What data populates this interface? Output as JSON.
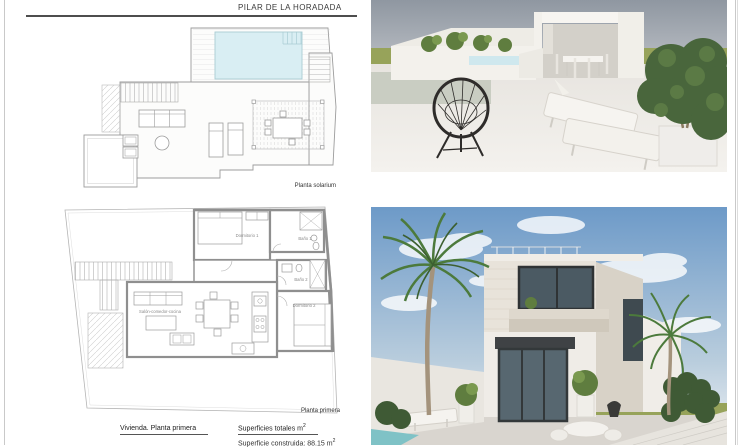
{
  "page": {
    "title": "PILAR DE LA HORADADA"
  },
  "plans": {
    "solarium": {
      "label": "Planta solarium"
    },
    "primera": {
      "label": "Planta primera",
      "rooms": {
        "dormitorio1": "Dormitorio 1",
        "bano1": "Baño 1",
        "bano2": "Baño 2",
        "dormitorio2": "Dormitorio 2",
        "salon": "Salón-comedor-cocina"
      }
    }
  },
  "footer": {
    "plan_caption": "Vivienda. Planta primera",
    "areas_heading_base": "Superficies totales m",
    "areas_heading_sup": "2",
    "areas_line1_base": "Superficie construida: 88.15 m",
    "areas_line1_sup": "2"
  },
  "colors": {
    "pool": "#d9eef3",
    "pool_glimpse": "#cfe8ee",
    "wall_line": "#8f8f8f",
    "field_green": "#97a35a",
    "sky_grey": "#939aa4",
    "sky_blue": "#6d9ac8"
  }
}
